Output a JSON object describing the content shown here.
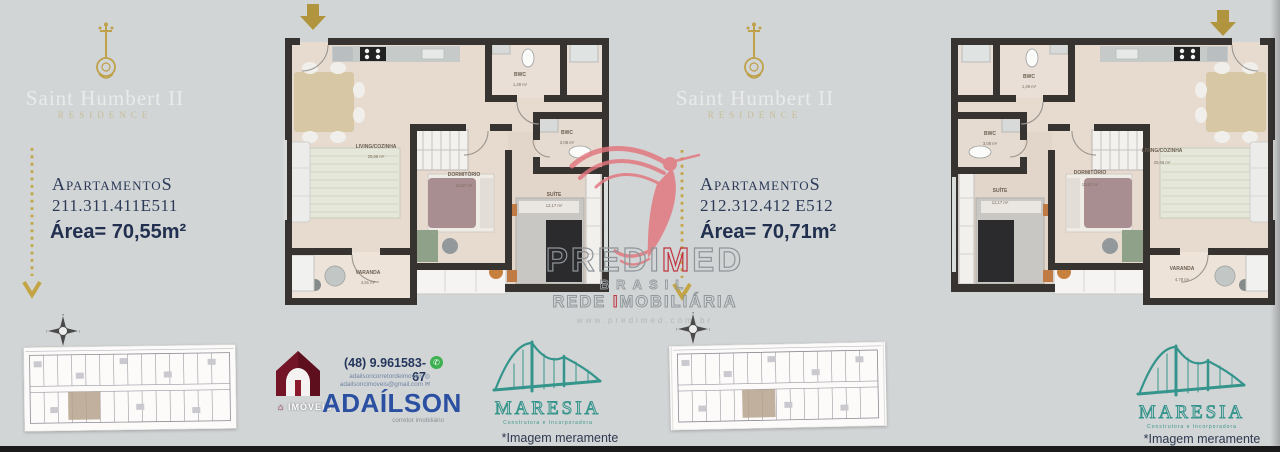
{
  "brand": {
    "title": "Saint Humbert II",
    "subtitle": "RESIDENCE"
  },
  "left_panel": {
    "apartments_label": "ApartamentoS",
    "apartment_numbers": "211.311.411E511",
    "area": "Área= 70,55m²"
  },
  "right_panel": {
    "apartments_label": "ApartamentoS",
    "apartment_numbers": "212.312.412 E512",
    "area": "Área= 70,71m²"
  },
  "plans": {
    "left": {
      "living_name": "LIVING/COZINHA",
      "living_area": "25,66 m²",
      "dorm_name": "DORMITÓRIO",
      "dorm_area": "10,57 m²",
      "suite_name": "SUÍTE",
      "suite_area": "12,17 m²",
      "bwc1_name": "BWC",
      "bwc1_area": "1,49 m²",
      "bwc2_name": "BWC",
      "bwc2_area": "3,08 m²",
      "varanda_name": "VARANDA",
      "varanda_area": "4,81 m²"
    },
    "right": {
      "living_name": "LIVING/COZINHA",
      "living_area": "25,66 m²",
      "dorm_name": "DORMITÓRIO",
      "dorm_area": "10,57 m²",
      "suite_name": "SUÍTE",
      "suite_area": "12,17 m²",
      "bwc1_name": "BWC",
      "bwc1_area": "1,49 m²",
      "bwc2_name": "BWC",
      "bwc2_area": "3,08 m²",
      "varanda_name": "VARANDA",
      "varanda_area": "4,78 m²"
    }
  },
  "watermark": {
    "brand_pre": "PREDI",
    "brand_m": "M",
    "brand_post": "ED",
    "line2": "BRASIL",
    "line3_pre": "REDE ",
    "line3_i": "I",
    "line3_post": "MOBILIÁRIA",
    "url": "www.predimed.com.br"
  },
  "contact": {
    "phone": "(48) 9.961583-67",
    "social": "adailsoncorretordeimoveis",
    "email": "adailsoncimoveis@gmail.com",
    "name": "ADAÍLSON",
    "role": "corretor imobiliário",
    "logo_label": "IMÓVEIS"
  },
  "maresia": {
    "name": "MARESIA",
    "tagline": "Construtora e Incorporadora"
  },
  "disclaimer": "*Imagem meramente ilustrativa",
  "colors": {
    "gold": "#b99a3e",
    "navy": "#2c3a57",
    "teal": "#35958c",
    "blue": "#2b4fa1",
    "maroon": "#731526",
    "pink": "#e2757e"
  }
}
